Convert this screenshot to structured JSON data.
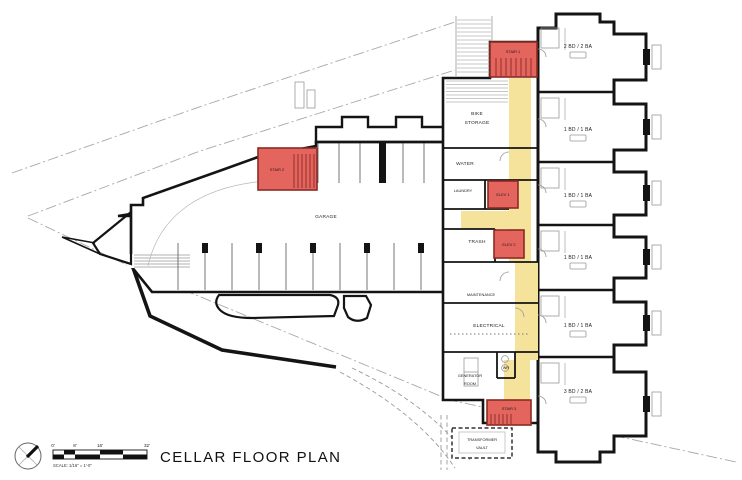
{
  "drawing": {
    "title": "CELLAR FLOOR PLAN",
    "scale_note": "SCALE: 1/16\" = 1'-0\"",
    "scale_ticks": [
      "0'",
      "8'",
      "16'",
      "32'"
    ]
  },
  "colors": {
    "highlight": "#e4645e",
    "highlight-border": "#8a2b24",
    "corridor": "#f5e39b",
    "wall": "#141414"
  },
  "rooms": {
    "garage": "GARAGE",
    "bike_storage_1": "BIKE",
    "bike_storage_2": "STORAGE",
    "water": "WATER",
    "laundry": "LAUNDRY",
    "trash": "TRASH",
    "maintenance": "MAINTENANCE",
    "electrical": "ELECTRICAL",
    "generator_1": "GENERATOR",
    "generator_2": "ROOM",
    "wr": "WR",
    "stair1": "STAIR 1",
    "stair2": "STAIR 2",
    "stair3": "STAIR 3",
    "elev1": "ELEV 1",
    "elev2": "ELEV 2",
    "transformer_1": "TRANSFORMER",
    "transformer_2": "VAULT"
  },
  "units": [
    {
      "label": "2 BD / 2 BA"
    },
    {
      "label": "1 BD / 1 BA"
    },
    {
      "label": "1 BD / 1 BA"
    },
    {
      "label": "1 BD / 1 BA"
    },
    {
      "label": "1 BD / 1 BA"
    },
    {
      "label": "3 BD / 2 BA"
    }
  ]
}
